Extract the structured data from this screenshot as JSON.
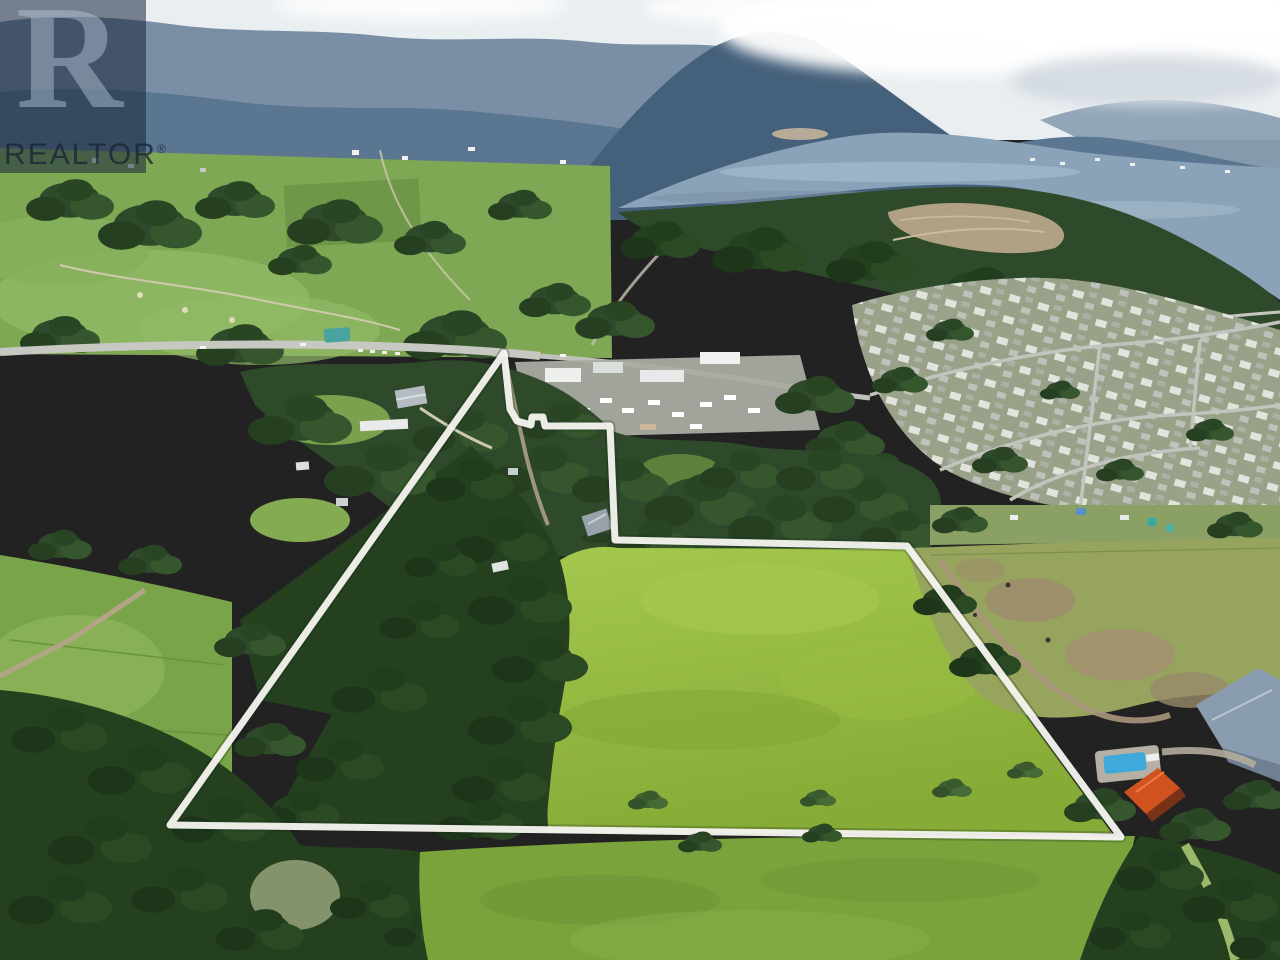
{
  "watermark": {
    "logo_letter": "R",
    "brand": "REALTOR",
    "registered_mark": "®",
    "box_color": "rgba(22,37,58,0.55)",
    "logo_color": "rgba(186,201,221,0.45)",
    "text_color": "rgba(25,36,52,0.78)"
  },
  "boundary": {
    "points": "504,353 510,409 517,421 531,425 532,417 543,417 545,426 610,426 615,540 907,546 1121,837 170,825",
    "stroke": "#f7f6f1",
    "width": "7",
    "shadow_stroke": "rgba(20,40,20,0.25)",
    "shadow_width": "11"
  },
  "scene": {
    "description": "Aerial view of rural acreage outlined in white, with forest, fields, a town, Shuswap Lake and mountains beyond",
    "colors": {
      "sky": "#e9eef1",
      "cloud": "#ffffff",
      "cloud_shade": "#ccd5dc",
      "mountain_far": "#7a8fa5",
      "mountain_mid": "#5b7690",
      "mountain_near": "#45607a",
      "lake": "#8ba3b8",
      "lake_highlight": "#a9bfd0",
      "field_upper": "#7fa854",
      "field_parcel": "#86ab36",
      "field_parcel_light": "#a4c84e",
      "field_lower": "#7ba33c",
      "field_west": "#7aa449",
      "pasture": "#96a45e",
      "forest": "#2e4a2a",
      "forest_dark": "#24401f",
      "road": "#c8c8c2",
      "dirt_road": "#b3a58a",
      "clearing": "#b0a184",
      "town_base": "#99a289",
      "commercial": "#a9aca2",
      "house_roof": "#d0521f",
      "pool": "#3fa9dc",
      "barn_roof": "#8a9cb0",
      "shed_roof": "#97a2ab",
      "teal_roof": "#4aa39f"
    }
  }
}
